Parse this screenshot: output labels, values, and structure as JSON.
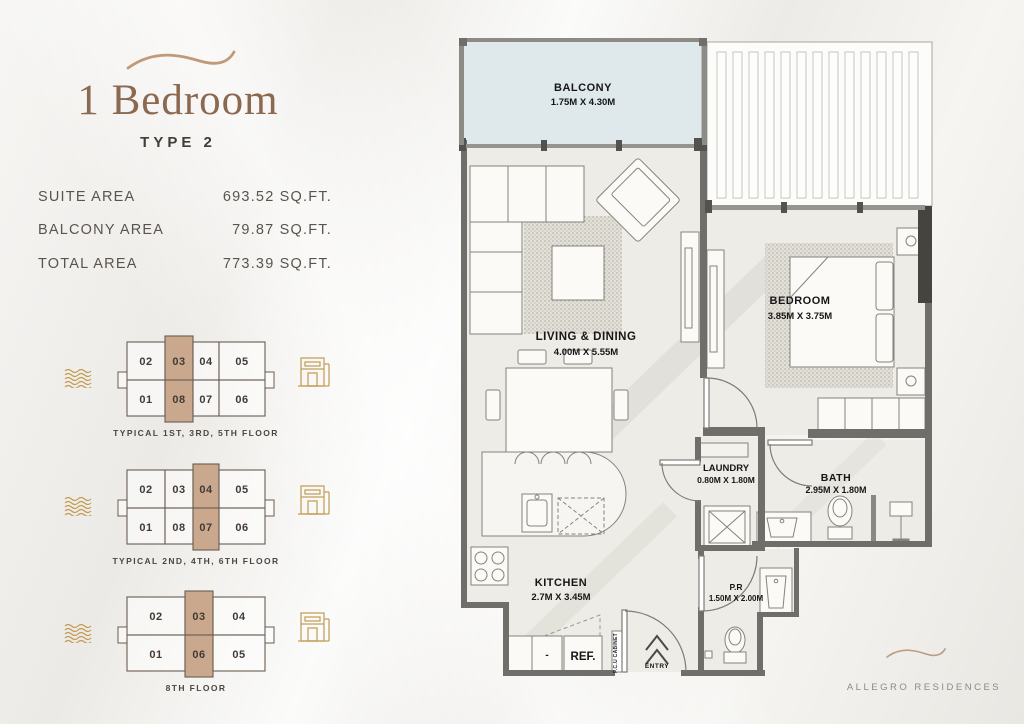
{
  "sidebar": {
    "title": "1 Bedroom",
    "subtitle": "TYPE 2",
    "areas": [
      {
        "label": "SUITE AREA",
        "value": "693.52 SQ.FT."
      },
      {
        "label": "BALCONY AREA",
        "value": "79.87 SQ.FT."
      },
      {
        "label": "TOTAL AREA",
        "value": "773.39 SQ.FT."
      }
    ],
    "floor_plates": [
      {
        "caption": "TYPICAL 1ST, 3RD, 5TH FLOOR",
        "top_row": [
          {
            "label": "02"
          },
          {
            "label": "03",
            "highlighted": true
          },
          {
            "label": "04"
          },
          {
            "label": "05"
          }
        ],
        "bottom_row": [
          {
            "label": "01"
          },
          {
            "label": "08",
            "highlighted": true
          },
          {
            "label": "07"
          },
          {
            "label": "06"
          }
        ]
      },
      {
        "caption": "TYPICAL 2ND, 4TH, 6TH FLOOR",
        "top_row": [
          {
            "label": "02"
          },
          {
            "label": "03"
          },
          {
            "label": "04",
            "highlighted": true
          },
          {
            "label": "05"
          }
        ],
        "bottom_row": [
          {
            "label": "01"
          },
          {
            "label": "08"
          },
          {
            "label": "07",
            "highlighted": true
          },
          {
            "label": "06"
          }
        ]
      },
      {
        "caption": "8TH FLOOR",
        "top_row": [
          {
            "label": "02"
          },
          {
            "label": "03",
            "highlighted": true
          },
          {
            "label": "04"
          }
        ],
        "bottom_row": [
          {
            "label": "01"
          },
          {
            "label": "06",
            "highlighted": true
          },
          {
            "label": "05"
          }
        ]
      }
    ]
  },
  "floor_plan": {
    "rooms": {
      "balcony": {
        "name": "BALCONY",
        "dims": "1.75M X 4.30M"
      },
      "living": {
        "name": "LIVING & DINING",
        "dims": "4.00M X 5.55M"
      },
      "bedroom": {
        "name": "BEDROOM",
        "dims": "3.85M X 3.75M"
      },
      "laundry": {
        "name": "LAUNDRY",
        "dims": "0.80M X 1.80M"
      },
      "bath": {
        "name": "BATH",
        "dims": "2.95M X 1.80M"
      },
      "kitchen": {
        "name": "KITCHEN",
        "dims": "2.7M X 3.45M"
      },
      "powder_room": {
        "name": "P.R",
        "dims": "1.50M X 2.00M"
      }
    },
    "labels": {
      "fridge": "REF.",
      "entry": "ENTRY",
      "cabinet": "F.C.U CABINET",
      "cabinet_dash": "-"
    }
  },
  "footer": {
    "brand": "ALLEGRO RESIDENCES"
  },
  "colors": {
    "accent_tan": "#c9a88d",
    "brand_brown": "#8a6950",
    "gold": "#c39b52",
    "wall_gray": "#6f6e6a",
    "balcony_blue": "#dfe9ec",
    "floor": "#edece6"
  }
}
